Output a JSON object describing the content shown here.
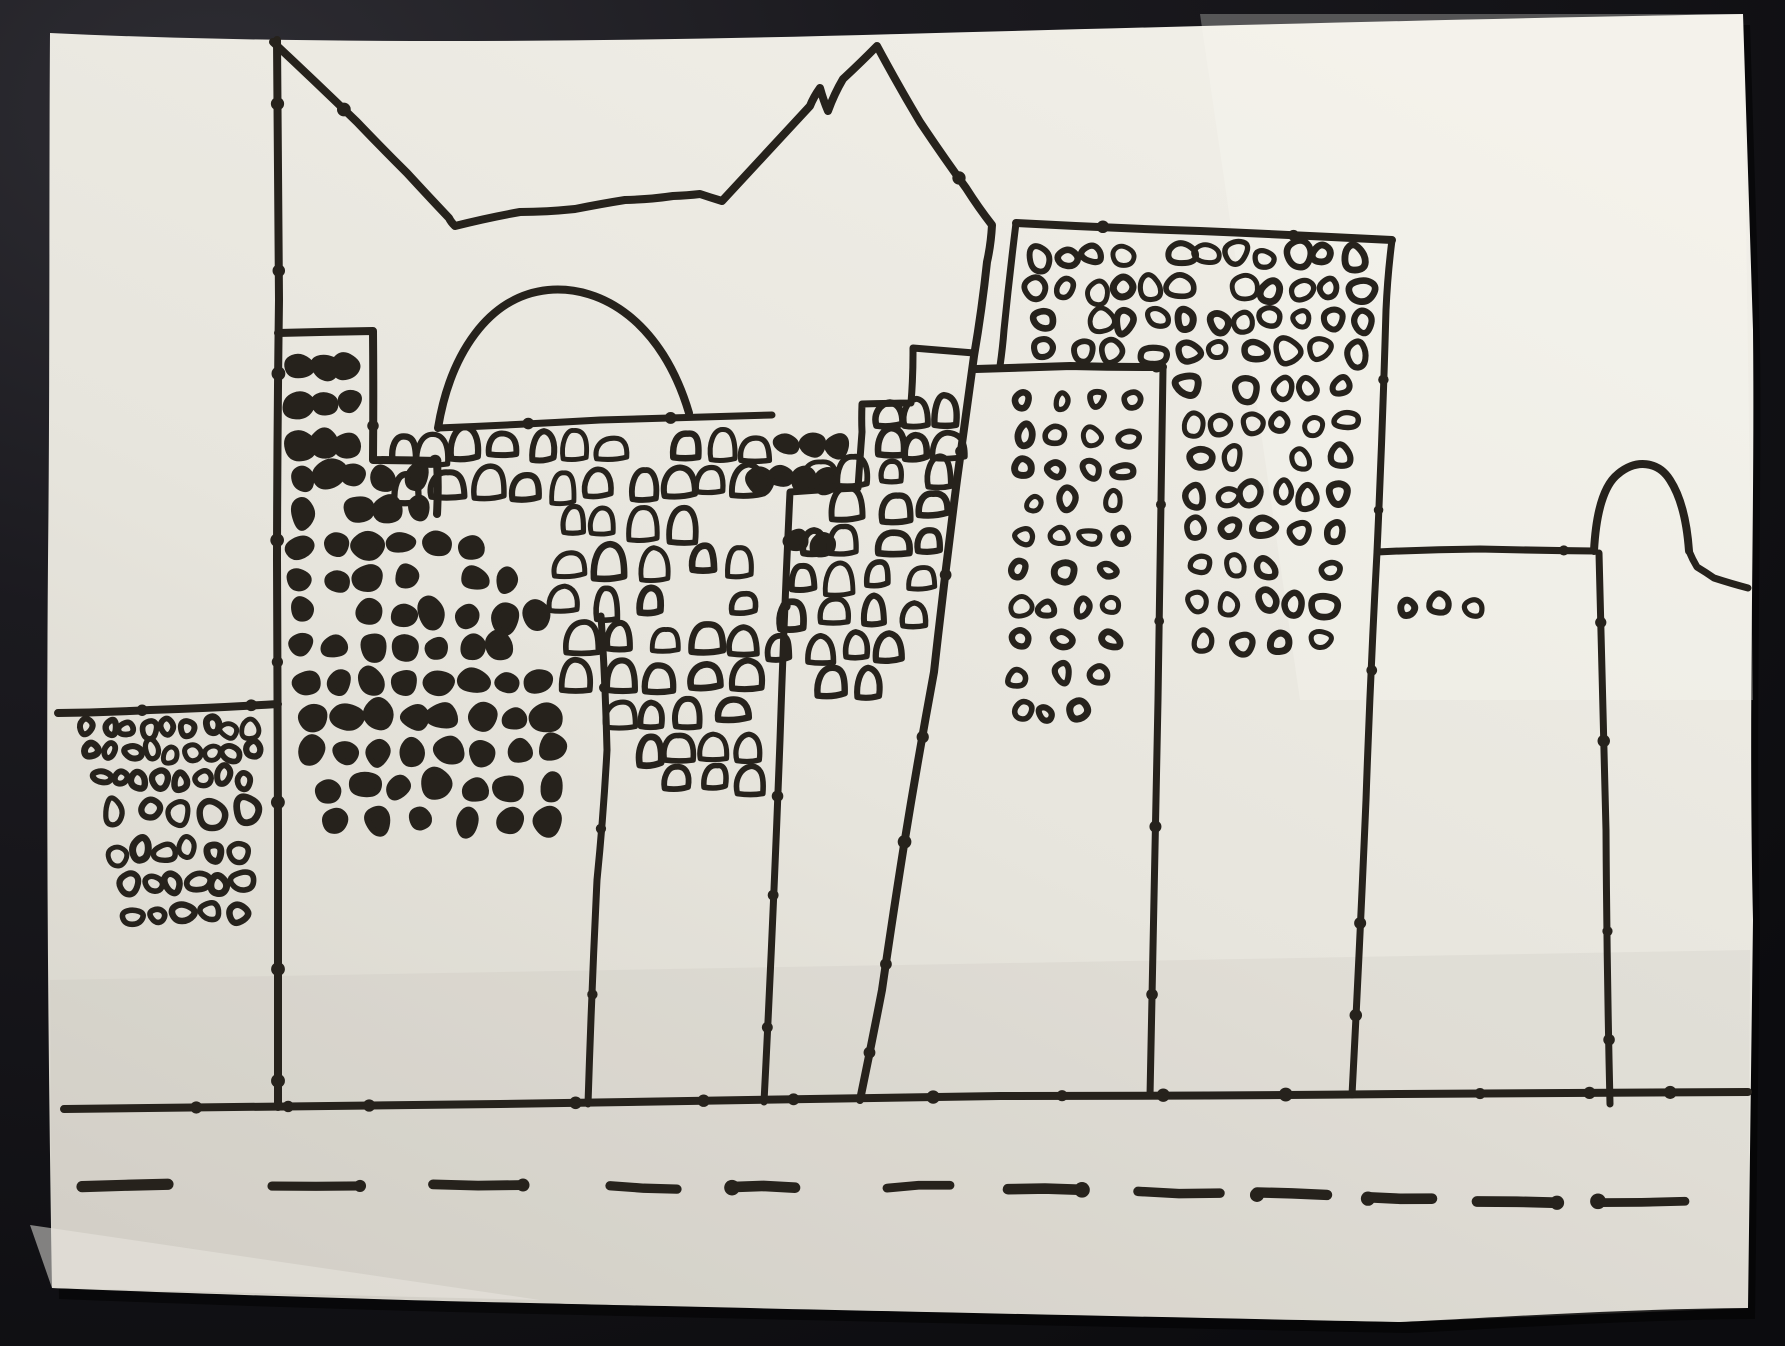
{
  "scene": {
    "description": "Photograph of a hand-drawn black marker sketch on white paper lying on a dark surface: a city skyline of stepped skyscrapers covered in small scribbled windows, a dome, a rounded tower at right, a ground line and a dashed road line",
    "medium": "black marker ink on light paper",
    "elements": [
      "left-low-apartment-block",
      "tall-spine-line",
      "dark-window-tower",
      "dome",
      "mid-stepped-tower",
      "leaning-tower",
      "big-back-building",
      "front-right-building",
      "rounded-hump-tower",
      "ground-line",
      "dashed-road-line"
    ]
  },
  "colors": {
    "background_dark": "#141318",
    "background_corner": "#2c2b31",
    "paper_light": "#efede6",
    "paper_shadow": "#d6d3ca",
    "ink": "#26221c"
  },
  "drawing": {
    "canvas": {
      "width": 1785,
      "height": 1346
    },
    "seed": 11,
    "paper": {
      "outline": "M 50,33 C 300,45 620,42 900,34 C 1200,26 1500,18 1743,14 L 1753,330 C 1755,520 1748,700 1753,920 L 1748,1308 C 1610,1309 1475,1319 1400,1322 C 1100,1316 700,1307 530,1303 C 380,1300 150,1292 52,1288 C 48,1050 46,800 48,560 C 50,380 49,160 50,33 Z",
      "shades": [
        {
          "path": "M 30,1225 L 540,1300 L 52,1288 Z",
          "fill": "#f4f2ec",
          "opacity": 0.5
        },
        {
          "path": "M 50,980 L 1750,950 L 1748,1308 L 1400,1322 L 530,1303 L 52,1288 Z",
          "fill": "#b9b6ae",
          "opacity": 0.16
        },
        {
          "path": "M 1200,14 L 1743,14 L 1753,700 L 1300,700 Z",
          "fill": "#fbfaf6",
          "opacity": 0.28
        }
      ]
    },
    "strokes": [
      {
        "name": "spine-line",
        "points": [
          [
            277,
            40
          ],
          [
            279,
            300
          ],
          [
            277,
            560
          ],
          [
            278,
            830
          ],
          [
            278,
            1107
          ]
        ],
        "w": 8
      },
      {
        "name": "peak-and-leaning-edge",
        "points": [
          [
            273,
            42
          ],
          [
            357,
            122
          ],
          [
            407,
            173
          ],
          [
            449,
            218
          ],
          [
            455,
            226
          ],
          [
            520,
            212
          ],
          [
            575,
            209
          ],
          [
            625,
            200
          ],
          [
            673,
            196
          ],
          [
            700,
            194
          ],
          [
            722,
            201
          ],
          [
            810,
            106
          ],
          [
            820,
            88
          ],
          [
            828,
            111
          ],
          [
            843,
            79
          ],
          [
            877,
            46
          ],
          [
            920,
            122
          ],
          [
            966,
            188
          ],
          [
            992,
            225
          ],
          [
            987,
            262
          ],
          [
            974,
            356
          ],
          [
            957,
            480
          ],
          [
            934,
            672
          ],
          [
            904,
            845
          ],
          [
            882,
            990
          ],
          [
            860,
            1100
          ]
        ],
        "w": 8
      },
      {
        "name": "left-block-top",
        "points": [
          [
            58,
            713
          ],
          [
            150,
            710
          ],
          [
            278,
            704
          ]
        ],
        "w": 8
      },
      {
        "name": "ground-line",
        "points": [
          [
            64,
            1109
          ],
          [
            500,
            1104
          ],
          [
            1000,
            1096
          ],
          [
            1400,
            1094
          ],
          [
            1748,
            1092
          ]
        ],
        "w": 8
      },
      {
        "name": "dark-tower-top-box",
        "points": [
          [
            278,
            333
          ],
          [
            373,
            331
          ],
          [
            373,
            460
          ],
          [
            437,
            461
          ],
          [
            437,
            514
          ]
        ],
        "w": 8
      },
      {
        "name": "dome-arc",
        "path": "M 438,428 C 450,355 488,296 548,290 C 602,285 662,322 689,413",
        "w": 8
      },
      {
        "name": "dome-base-chord",
        "points": [
          [
            438,
            428
          ],
          [
            600,
            420
          ],
          [
            772,
            415
          ]
        ],
        "w": 7
      },
      {
        "name": "mid-tower-steps",
        "points": [
          [
            764,
            1102
          ],
          [
            780,
            740
          ],
          [
            790,
            492
          ],
          [
            858,
            488
          ],
          [
            862,
            432
          ],
          [
            862,
            404
          ],
          [
            911,
            403
          ],
          [
            913,
            348
          ],
          [
            974,
            353
          ]
        ],
        "w": 7
      },
      {
        "name": "center-building-right-edge",
        "points": [
          [
            601,
            616
          ],
          [
            607,
            750
          ],
          [
            597,
            880
          ],
          [
            588,
            1104
          ]
        ],
        "w": 7
      },
      {
        "name": "leaning-tower-top",
        "points": [
          [
            976,
            369
          ],
          [
            1070,
            366
          ],
          [
            1163,
            367
          ]
        ],
        "w": 8
      },
      {
        "name": "leaning-tower-right-edge",
        "points": [
          [
            1163,
            369
          ],
          [
            1158,
            700
          ],
          [
            1150,
            1096
          ]
        ],
        "w": 7
      },
      {
        "name": "big-building-top",
        "points": [
          [
            1016,
            223
          ],
          [
            1200,
            231
          ],
          [
            1392,
            240
          ]
        ],
        "w": 8
      },
      {
        "name": "big-building-left-edge",
        "points": [
          [
            1016,
            223
          ],
          [
            1004,
            330
          ],
          [
            1000,
            366
          ]
        ],
        "w": 7
      },
      {
        "name": "big-building-right-edge",
        "points": [
          [
            1392,
            240
          ],
          [
            1386,
            310
          ],
          [
            1377,
            552
          ],
          [
            1366,
            800
          ],
          [
            1352,
            1095
          ]
        ],
        "w": 7
      },
      {
        "name": "hump-building-top",
        "points": [
          [
            1377,
            552
          ],
          [
            1480,
            549
          ],
          [
            1594,
            551
          ]
        ],
        "w": 7
      },
      {
        "name": "hump-curve",
        "path": "M 1594,551 C 1596,512 1604,485 1618,474 C 1636,459 1658,461 1670,480 C 1681,497 1687,523 1689,551",
        "w": 8
      },
      {
        "name": "hump-right-tail",
        "points": [
          [
            1689,
            551
          ],
          [
            1697,
            567
          ],
          [
            1714,
            578
          ],
          [
            1748,
            588
          ]
        ],
        "w": 7
      },
      {
        "name": "hump-left-vertical",
        "points": [
          [
            1599,
            553
          ],
          [
            1606,
            830
          ],
          [
            1610,
            1104
          ]
        ],
        "w": 7
      }
    ],
    "window_zones": [
      {
        "name": "left-block-windows",
        "style": "outline",
        "shape": "blob",
        "rows": [
          [
            727,
            78,
            262,
            9,
            19
          ],
          [
            752,
            80,
            262,
            9,
            19
          ],
          [
            778,
            90,
            252,
            8,
            19
          ],
          [
            812,
            98,
            258,
            5,
            27
          ],
          [
            852,
            105,
            250,
            6,
            22
          ],
          [
            884,
            118,
            252,
            6,
            22
          ],
          [
            914,
            122,
            250,
            5,
            22
          ]
        ]
      },
      {
        "name": "dark-tower-windows",
        "style": "filled",
        "shape": "blob",
        "rows": [
          [
            366,
            290,
            358,
            3,
            26
          ],
          [
            404,
            290,
            358,
            3,
            26
          ],
          [
            444,
            290,
            360,
            3,
            26
          ],
          [
            477,
            287,
            428,
            5,
            27
          ],
          [
            510,
            287,
            430,
            5,
            27
          ],
          [
            545,
            286,
            520,
            7,
            27
          ],
          [
            580,
            286,
            522,
            7,
            27
          ],
          [
            614,
            287,
            552,
            8,
            26
          ],
          [
            648,
            288,
            554,
            8,
            26
          ],
          [
            682,
            290,
            558,
            8,
            26
          ],
          [
            716,
            294,
            562,
            8,
            26
          ],
          [
            752,
            298,
            566,
            8,
            26
          ],
          [
            788,
            304,
            570,
            7,
            27
          ],
          [
            820,
            310,
            574,
            6,
            25
          ],
          [
            447,
            772,
            850,
            3,
            24
          ],
          [
            479,
            746,
            842,
            4,
            24
          ],
          [
            543,
            780,
            838,
            2,
            24
          ]
        ]
      },
      {
        "name": "dome-band-windows",
        "style": "outline",
        "shape": "arch",
        "rows": [
          [
            446,
            382,
            770,
            11,
            26
          ],
          [
            484,
            392,
            772,
            10,
            27
          ]
        ]
      },
      {
        "name": "center-building-windows",
        "style": "outline",
        "shape": "arch",
        "rows": [
          [
            522,
            552,
            700,
            4,
            27
          ],
          [
            562,
            548,
            762,
            5,
            27
          ],
          [
            602,
            548,
            764,
            5,
            27
          ],
          [
            640,
            560,
            766,
            5,
            27
          ],
          [
            676,
            560,
            768,
            5,
            26
          ],
          [
            712,
            600,
            748,
            4,
            25
          ],
          [
            748,
            630,
            772,
            4,
            23
          ],
          [
            780,
            628,
            770,
            4,
            23
          ]
        ]
      },
      {
        "name": "mid-tower-windows",
        "style": "outline",
        "shape": "arch",
        "rows": [
          [
            412,
            872,
            958,
            3,
            25
          ],
          [
            444,
            872,
            960,
            3,
            26
          ],
          [
            474,
            794,
            958,
            4,
            26
          ],
          [
            506,
            792,
            952,
            4,
            26
          ],
          [
            540,
            790,
            948,
            4,
            26
          ],
          [
            576,
            786,
            940,
            4,
            26
          ],
          [
            612,
            776,
            928,
            4,
            25
          ],
          [
            647,
            766,
            910,
            4,
            25
          ],
          [
            681,
            758,
            894,
            3,
            24
          ]
        ]
      },
      {
        "name": "leaning-tower-windows",
        "style": "outline",
        "shape": "blob",
        "rows": [
          [
            400,
            1006,
            1148,
            4,
            20
          ],
          [
            435,
            1004,
            1146,
            4,
            21
          ],
          [
            468,
            1004,
            1144,
            4,
            21
          ],
          [
            502,
            1006,
            1140,
            3,
            21
          ],
          [
            536,
            1004,
            1138,
            4,
            21
          ],
          [
            572,
            1002,
            1134,
            3,
            21
          ],
          [
            607,
            1002,
            1130,
            4,
            21
          ],
          [
            641,
            1000,
            1126,
            3,
            21
          ],
          [
            676,
            1000,
            1122,
            3,
            20
          ],
          [
            712,
            1008,
            1090,
            3,
            19
          ]
        ]
      },
      {
        "name": "big-building-windows",
        "style": "outline",
        "shape": "blob",
        "rows": [
          [
            256,
            1022,
            1368,
            12,
            26
          ],
          [
            289,
            1024,
            1372,
            12,
            26
          ],
          [
            320,
            1026,
            1374,
            12,
            25
          ],
          [
            352,
            1030,
            1376,
            10,
            25
          ],
          [
            388,
            1176,
            1356,
            6,
            24
          ],
          [
            423,
            1178,
            1356,
            6,
            24
          ],
          [
            458,
            1180,
            1354,
            5,
            24
          ],
          [
            494,
            1182,
            1352,
            6,
            24
          ],
          [
            530,
            1182,
            1350,
            5,
            23
          ],
          [
            566,
            1184,
            1348,
            5,
            23
          ],
          [
            604,
            1186,
            1344,
            5,
            23
          ],
          [
            642,
            1188,
            1340,
            4,
            23
          ]
        ]
      },
      {
        "name": "hump-building-windows",
        "style": "outline",
        "shape": "blob",
        "rows": [
          [
            605,
            1396,
            1488,
            3,
            19
          ]
        ]
      }
    ],
    "road_dashes": [
      [
        82,
        168,
        1186
      ],
      [
        272,
        360,
        1186
      ],
      [
        433,
        523,
        1186
      ],
      [
        610,
        677,
        1187
      ],
      [
        732,
        795,
        1187
      ],
      [
        887,
        950,
        1188
      ],
      [
        1008,
        1082,
        1190
      ],
      [
        1138,
        1220,
        1192
      ],
      [
        1257,
        1327,
        1194
      ],
      [
        1368,
        1432,
        1196
      ],
      [
        1477,
        1557,
        1200
      ],
      [
        1598,
        1685,
        1203
      ]
    ]
  }
}
